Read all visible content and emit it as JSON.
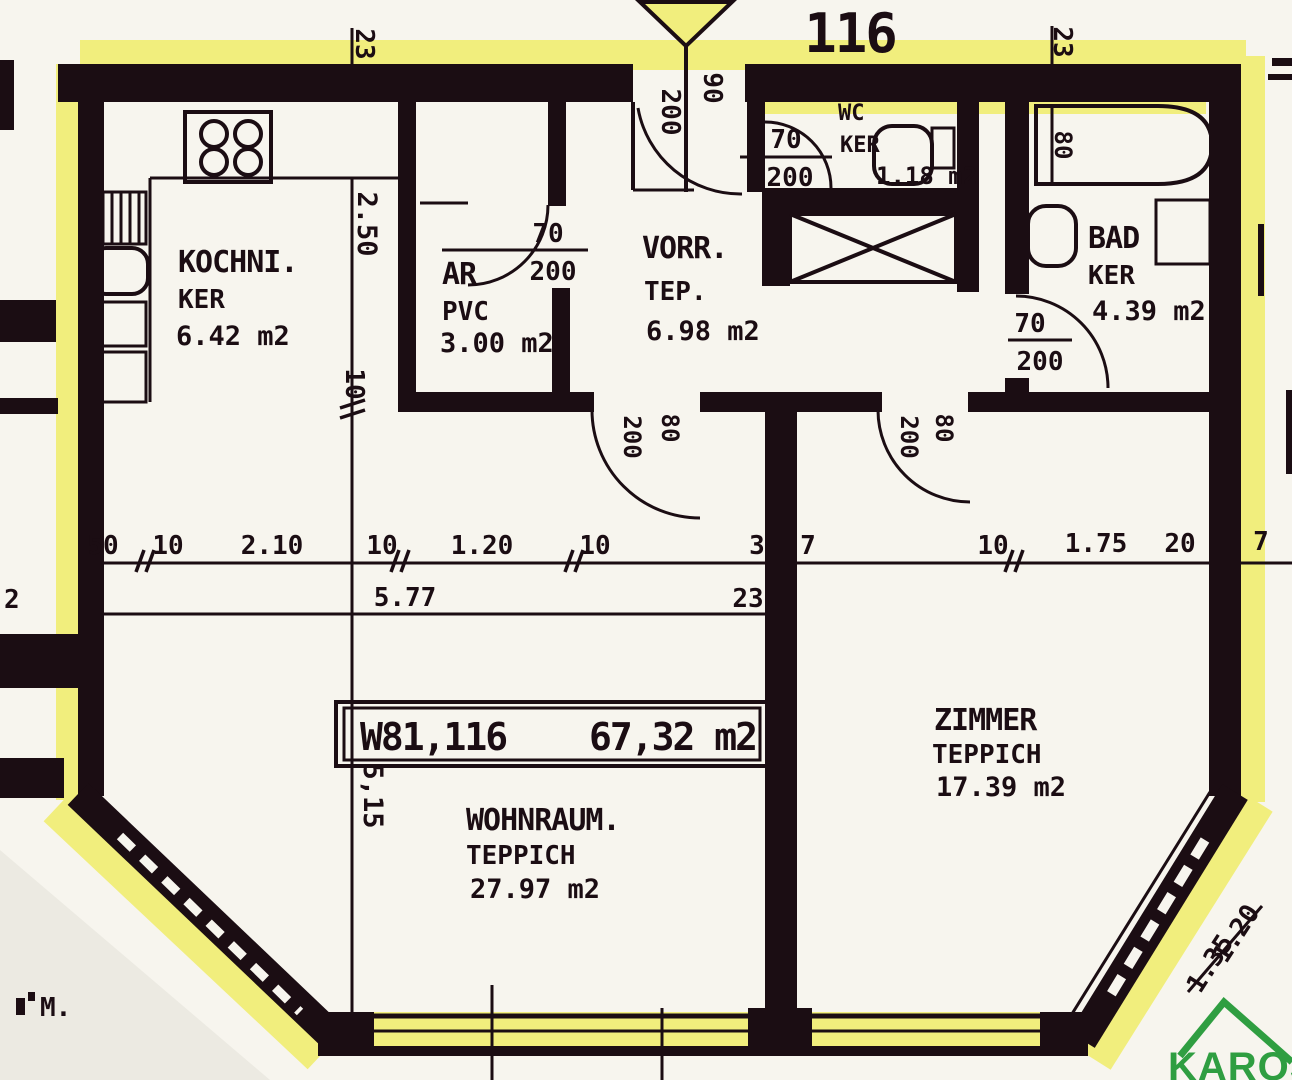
{
  "plan": {
    "apartment_number": "116",
    "unit_box": {
      "id": "W81,116",
      "area": "67,32 m2"
    },
    "rooms": {
      "kochnische": {
        "name": "KOCHNI.",
        "floor": "KER",
        "area": "6.42 m2"
      },
      "abstellraum": {
        "name": "AR",
        "floor": "PVC",
        "area": "3.00 m2"
      },
      "vorraum": {
        "name": "VORR.",
        "floor": "TEP.",
        "area": "6.98 m2"
      },
      "wc": {
        "name": "WC",
        "floor": "KER",
        "area": "1.18 m2"
      },
      "bad": {
        "name": "BAD",
        "floor": "KER",
        "area": "4.39 m2"
      },
      "wohnraum": {
        "name": "WOHNRAUM.",
        "floor": "TEPPICH",
        "area": "27.97 m2"
      },
      "zimmer": {
        "name": "ZIMMER",
        "floor": "TEPPICH",
        "area": "17.39 m2"
      }
    },
    "doors": {
      "entrance": {
        "height": "200",
        "width": "90"
      },
      "ar": {
        "width": "70",
        "height": "200"
      },
      "wc": {
        "width": "70",
        "height": "200"
      },
      "bad": {
        "width": "70",
        "height": "200"
      },
      "wohnraum": {
        "height": "200",
        "width": "80"
      },
      "zimmer": {
        "height": "200",
        "width": "80"
      }
    },
    "dimensions": {
      "wall_top_left": "23",
      "wall_top_right": "23",
      "main_line": [
        "50",
        "10",
        "2.10",
        "10",
        "1.20",
        "10",
        "3",
        "7",
        "10",
        "1.75",
        "20",
        "7"
      ],
      "sub_line_left": "2",
      "sub_line_width": "5.77",
      "sub_line_wall": "23",
      "kitchen_depth": "2.50",
      "kitchen_wall": "10",
      "living_depth": "5,15",
      "bath_tub": "80",
      "diag_window_a": "1.20",
      "diag_window_b": "1.35"
    },
    "corner_text": "M.",
    "colors": {
      "ink": "#1b0d13",
      "paper": "#f7f5ee",
      "highlight_yellow": "#f1ee7d"
    },
    "logo": {
      "text": "KAROS",
      "color": "#2f9e41"
    }
  }
}
